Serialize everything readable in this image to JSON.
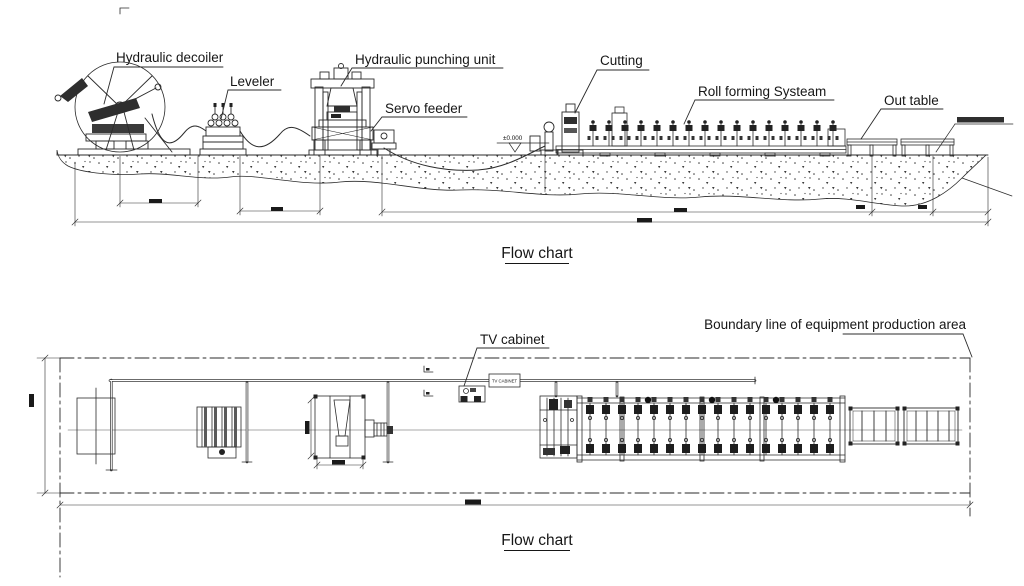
{
  "drawing": {
    "side_view": {
      "title": "Flow chart",
      "labels": {
        "hydraulic_decoiler": "Hydraulic decoiler",
        "leveler": "Leveler",
        "hydraulic_punching_unit": "Hydraulic punching unit",
        "servo_feeder": "Servo feeder",
        "cutting": "Cutting",
        "roll_forming_system": "Roll forming Systeam",
        "out_table": "Out table",
        "floor_level": "±0.000"
      }
    },
    "plan_view": {
      "title": "Flow chart",
      "labels": {
        "tv_cabinet": "TV cabinet",
        "tv_cabinet_box": "TV CABINET",
        "boundary_line": "Boundary line of equipment production area"
      }
    },
    "colors": {
      "line": "#2b2b2b",
      "background": "#ffffff",
      "dark_fill": "#222222"
    }
  }
}
